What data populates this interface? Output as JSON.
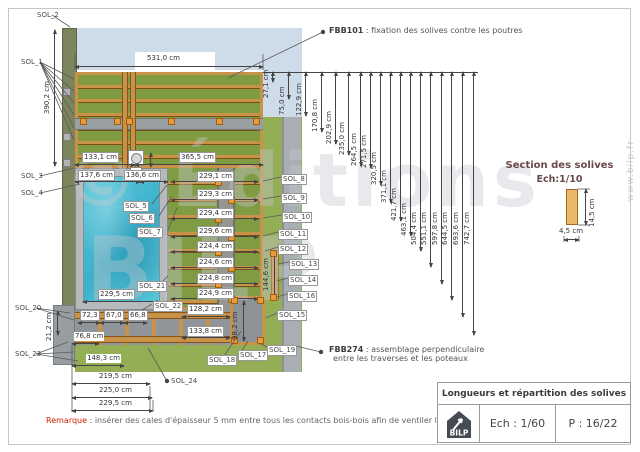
{
  "annotations": {
    "fbb101_code": "FBB101",
    "fbb101_text": " : fixation des solives contre les poutres",
    "fbb274_code": "FBB274",
    "fbb274_text1": " : assemblage perpendiculaire",
    "fbb274_text2": "entre les traverses et les poteaux"
  },
  "section_box": {
    "title": "Section des solives",
    "scale": "Ech:1/10",
    "width_label": "4,5 cm",
    "height_label": "14,5 cm"
  },
  "title_block": {
    "title": "Longueurs et répartition des solives",
    "logo": "BILP",
    "scale": "Ech : 1/60",
    "page": "P : 16/22"
  },
  "remark": {
    "label": "Remarque",
    "text": " : insérer des cales d'épaisseur 5 mm entre tous les contacts bois-bois afin de ventiler la structure"
  },
  "watermark": {
    "big1": "© Éditions",
    "big2": "BILP",
    "side": "www.bilp.fr"
  },
  "dims": {
    "chain": [
      {
        "label": "27,1 cm",
        "x": 272,
        "drop": 10
      },
      {
        "label": "75,0 cm",
        "x": 288,
        "drop": 27
      },
      {
        "label": "122,9 cm",
        "x": 305,
        "drop": 44
      },
      {
        "label": "170,8 cm",
        "x": 321,
        "drop": 60
      },
      {
        "label": "202,9 cm",
        "x": 335,
        "drop": 72
      },
      {
        "label": "235,0 cm",
        "x": 348,
        "drop": 83
      },
      {
        "label": "264,5 cm",
        "x": 360,
        "drop": 94
      },
      {
        "label": "271,5 cm",
        "x": 370,
        "drop": 96
      },
      {
        "label": "320,5 cm",
        "x": 380,
        "drop": 113
      },
      {
        "label": "371,1 cm",
        "x": 390,
        "drop": 131
      },
      {
        "label": "421,7 cm",
        "x": 400,
        "drop": 149
      },
      {
        "label": "463,1 cm",
        "x": 410,
        "drop": 164
      },
      {
        "label": "504,4 cm",
        "x": 420,
        "drop": 179
      },
      {
        "label": "551,1 cm",
        "x": 430,
        "drop": 195
      },
      {
        "label": "597,8 cm",
        "x": 441,
        "drop": 212
      },
      {
        "label": "644,5 cm",
        "x": 451,
        "drop": 228
      },
      {
        "label": "693,6 cm",
        "x": 462,
        "drop": 245
      },
      {
        "label": "742,7 cm",
        "x": 473,
        "drop": 263
      }
    ],
    "joist_rows": [
      {
        "label": "229,1 cm",
        "y": 181
      },
      {
        "label": "229,3 cm",
        "y": 199
      },
      {
        "label": "229,4 cm",
        "y": 218
      },
      {
        "label": "229,6 cm",
        "y": 236
      },
      {
        "label": "224,4 cm",
        "y": 251
      },
      {
        "label": "224,6 cm",
        "y": 267
      },
      {
        "label": "224,8 cm",
        "y": 283
      },
      {
        "label": "224,9 cm",
        "y": 298
      }
    ],
    "h_dims": [
      {
        "label": "531,0 cm",
        "x1": 75,
        "x2": 263,
        "y": 66,
        "lx": 146,
        "ly": 54,
        "boxed": false
      },
      {
        "label": "133,1 cm",
        "x1": 75,
        "x2": 135,
        "y": 164,
        "lx": 82,
        "ly": 152,
        "boxed": true
      },
      {
        "label": "365,5 cm",
        "x1": 135,
        "x2": 263,
        "y": 164,
        "lx": 179,
        "ly": 152,
        "boxed": true
      },
      {
        "label": "137,6 cm",
        "x1": 75,
        "x2": 140,
        "y": 181,
        "lx": 78,
        "ly": 170,
        "boxed": true
      },
      {
        "label": "136,6 cm",
        "x1": 140,
        "x2": 168,
        "y": 181,
        "lx": 124,
        "ly": 170,
        "boxed": true
      },
      {
        "label": "229,5 cm",
        "x1": 83,
        "x2": 160,
        "y": 301,
        "lx": 98,
        "ly": 289,
        "boxed": true
      },
      {
        "label": "72,3",
        "x1": 78,
        "x2": 100,
        "y": 322,
        "lx": 80,
        "ly": 310,
        "boxed": true
      },
      {
        "label": "67,0",
        "x1": 100,
        "x2": 124,
        "y": 322,
        "lx": 104,
        "ly": 310,
        "boxed": true
      },
      {
        "label": "66,8",
        "x1": 124,
        "x2": 147,
        "y": 322,
        "lx": 128,
        "ly": 310,
        "boxed": true
      },
      {
        "label": "76,8 cm",
        "x1": 72,
        "x2": 99,
        "y": 343,
        "lx": 74,
        "ly": 332,
        "boxed": false
      },
      {
        "label": "148,3 cm",
        "x1": 72,
        "x2": 124,
        "y": 365,
        "lx": 86,
        "ly": 354,
        "boxed": false
      },
      {
        "label": "219,5 cm",
        "x1": 72,
        "x2": 150,
        "y": 383,
        "lx": 98,
        "ly": 372,
        "boxed": false
      },
      {
        "label": "225,0 cm",
        "x1": 72,
        "x2": 152,
        "y": 397,
        "lx": 98,
        "ly": 386,
        "boxed": false
      },
      {
        "label": "229,5 cm",
        "x1": 72,
        "x2": 153,
        "y": 410,
        "lx": 98,
        "ly": 399,
        "boxed": false
      },
      {
        "label": "128,2 cm",
        "x1": 182,
        "x2": 230,
        "y": 316,
        "lx": 187,
        "ly": 304,
        "boxed": true
      },
      {
        "label": "133,8 cm",
        "x1": 182,
        "x2": 230,
        "y": 337,
        "lx": 187,
        "ly": 326,
        "boxed": true
      },
      {
        "label": "4,5 cm",
        "x1": 564,
        "x2": 579,
        "y": 239,
        "lx": 558,
        "ly": 227,
        "boxed": false
      }
    ],
    "v_dims": [
      {
        "label": "390,2 cm",
        "x": 54,
        "y1": 30,
        "y2": 166,
        "lx": 43,
        "ly": 76
      },
      {
        "label": "21,2 cm",
        "x": 57,
        "y1": 311,
        "y2": 335,
        "lx": 45,
        "ly": 303
      },
      {
        "label": "98,2 cm",
        "x": 243,
        "y1": 301,
        "y2": 341,
        "lx": 231,
        "ly": 302
      },
      {
        "label": "144,6 cm",
        "x": 274,
        "y1": 252,
        "y2": 298,
        "lx": 262,
        "ly": 253
      },
      {
        "label": "14,5 cm",
        "x": 585,
        "y1": 189,
        "y2": 225,
        "lx": 588,
        "ly": 189
      },
      {
        "label": "",
        "x": 150,
        "y1": 153,
        "y2": 167,
        "lx": 152,
        "ly": 154
      }
    ]
  },
  "labels": [
    {
      "id": "SOL_1",
      "x": 20,
      "y": 58,
      "boxed": false
    },
    {
      "id": "SOL_2",
      "x": 36,
      "y": 11,
      "boxed": false
    },
    {
      "id": "SOL_3",
      "x": 20,
      "y": 172,
      "boxed": false
    },
    {
      "id": "SOL_4",
      "x": 20,
      "y": 189,
      "boxed": false
    },
    {
      "id": "SOL_5",
      "x": 123,
      "y": 201,
      "boxed": true
    },
    {
      "id": "SOL_6",
      "x": 129,
      "y": 213,
      "boxed": true
    },
    {
      "id": "SOL_7",
      "x": 137,
      "y": 227,
      "boxed": true
    },
    {
      "id": "SOL_8",
      "x": 281,
      "y": 174,
      "boxed": true
    },
    {
      "id": "SOL_9",
      "x": 281,
      "y": 193,
      "boxed": true
    },
    {
      "id": "SOL_10",
      "x": 282,
      "y": 212,
      "boxed": true
    },
    {
      "id": "SOL_11",
      "x": 278,
      "y": 229,
      "boxed": true
    },
    {
      "id": "SOL_12",
      "x": 278,
      "y": 244,
      "boxed": true
    },
    {
      "id": "SOL_13",
      "x": 289,
      "y": 259,
      "boxed": true
    },
    {
      "id": "SOL_14",
      "x": 288,
      "y": 275,
      "boxed": true
    },
    {
      "id": "SOL_16",
      "x": 287,
      "y": 291,
      "boxed": true
    },
    {
      "id": "SOL_15",
      "x": 277,
      "y": 310,
      "boxed": true
    },
    {
      "id": "SOL_17",
      "x": 238,
      "y": 350,
      "boxed": true
    },
    {
      "id": "SOL_18",
      "x": 207,
      "y": 355,
      "boxed": true
    },
    {
      "id": "SOL_19",
      "x": 267,
      "y": 345,
      "boxed": true
    },
    {
      "id": "SOL_20",
      "x": 14,
      "y": 304,
      "boxed": false
    },
    {
      "id": "SOL_21",
      "x": 137,
      "y": 281,
      "boxed": true
    },
    {
      "id": "SOL_22",
      "x": 153,
      "y": 301,
      "boxed": true
    },
    {
      "id": "SOL_23",
      "x": 14,
      "y": 350,
      "boxed": false
    },
    {
      "id": "SOL_24",
      "x": 170,
      "y": 377,
      "boxed": false
    }
  ],
  "squares": [
    [
      80,
      118
    ],
    [
      114,
      118
    ],
    [
      126,
      118
    ],
    [
      168,
      118
    ],
    [
      216,
      118
    ],
    [
      253,
      118
    ],
    [
      215,
      179
    ],
    [
      228,
      197
    ],
    [
      215,
      216
    ],
    [
      228,
      234
    ],
    [
      215,
      249
    ],
    [
      228,
      265
    ],
    [
      215,
      281
    ],
    [
      228,
      296
    ],
    [
      270,
      250
    ],
    [
      270,
      294
    ],
    [
      231,
      297
    ],
    [
      257,
      297
    ],
    [
      231,
      337
    ],
    [
      257,
      337
    ]
  ],
  "leaders": [
    [
      52,
      15,
      70,
      27
    ],
    [
      40,
      62,
      74,
      79
    ],
    [
      40,
      62,
      74,
      91
    ],
    [
      40,
      62,
      74,
      103
    ],
    [
      40,
      62,
      74,
      115
    ],
    [
      40,
      62,
      74,
      128
    ],
    [
      40,
      62,
      74,
      140
    ],
    [
      40,
      176,
      74,
      168
    ],
    [
      40,
      193,
      80,
      184
    ],
    [
      36,
      308,
      70,
      313
    ],
    [
      36,
      308,
      74,
      320
    ],
    [
      36,
      354,
      68,
      342
    ],
    [
      36,
      354,
      74,
      352
    ],
    [
      36,
      354,
      78,
      361
    ],
    [
      167,
      381,
      148,
      348
    ],
    [
      323,
      32,
      228,
      78
    ],
    [
      321,
      352,
      296,
      346
    ],
    [
      152,
      204,
      167,
      185
    ],
    [
      159,
      216,
      172,
      196
    ],
    [
      168,
      230,
      177,
      208
    ],
    [
      160,
      284,
      168,
      276
    ],
    [
      152,
      304,
      142,
      310
    ],
    [
      281,
      177,
      263,
      181
    ],
    [
      281,
      196,
      263,
      199
    ],
    [
      282,
      215,
      263,
      218
    ],
    [
      278,
      232,
      263,
      236
    ],
    [
      278,
      247,
      265,
      251
    ],
    [
      289,
      262,
      278,
      264
    ],
    [
      288,
      278,
      277,
      281
    ],
    [
      287,
      294,
      277,
      297
    ],
    [
      277,
      313,
      266,
      318
    ],
    [
      241,
      352,
      248,
      341
    ],
    [
      224,
      356,
      241,
      331
    ],
    [
      269,
      348,
      261,
      344
    ],
    [
      75,
      54,
      75,
      70
    ],
    [
      263,
      54,
      263,
      70
    ],
    [
      72,
      345,
      72,
      412
    ],
    [
      150,
      386,
      150,
      411
    ],
    [
      153,
      400,
      153,
      411
    ],
    [
      564,
      228,
      564,
      242
    ],
    [
      579,
      228,
      579,
      242
    ],
    [
      578,
      189,
      590,
      189
    ],
    [
      578,
      225,
      590,
      225
    ]
  ],
  "bullets": [
    [
      323,
      32
    ],
    [
      321,
      352
    ],
    [
      167,
      381
    ]
  ]
}
